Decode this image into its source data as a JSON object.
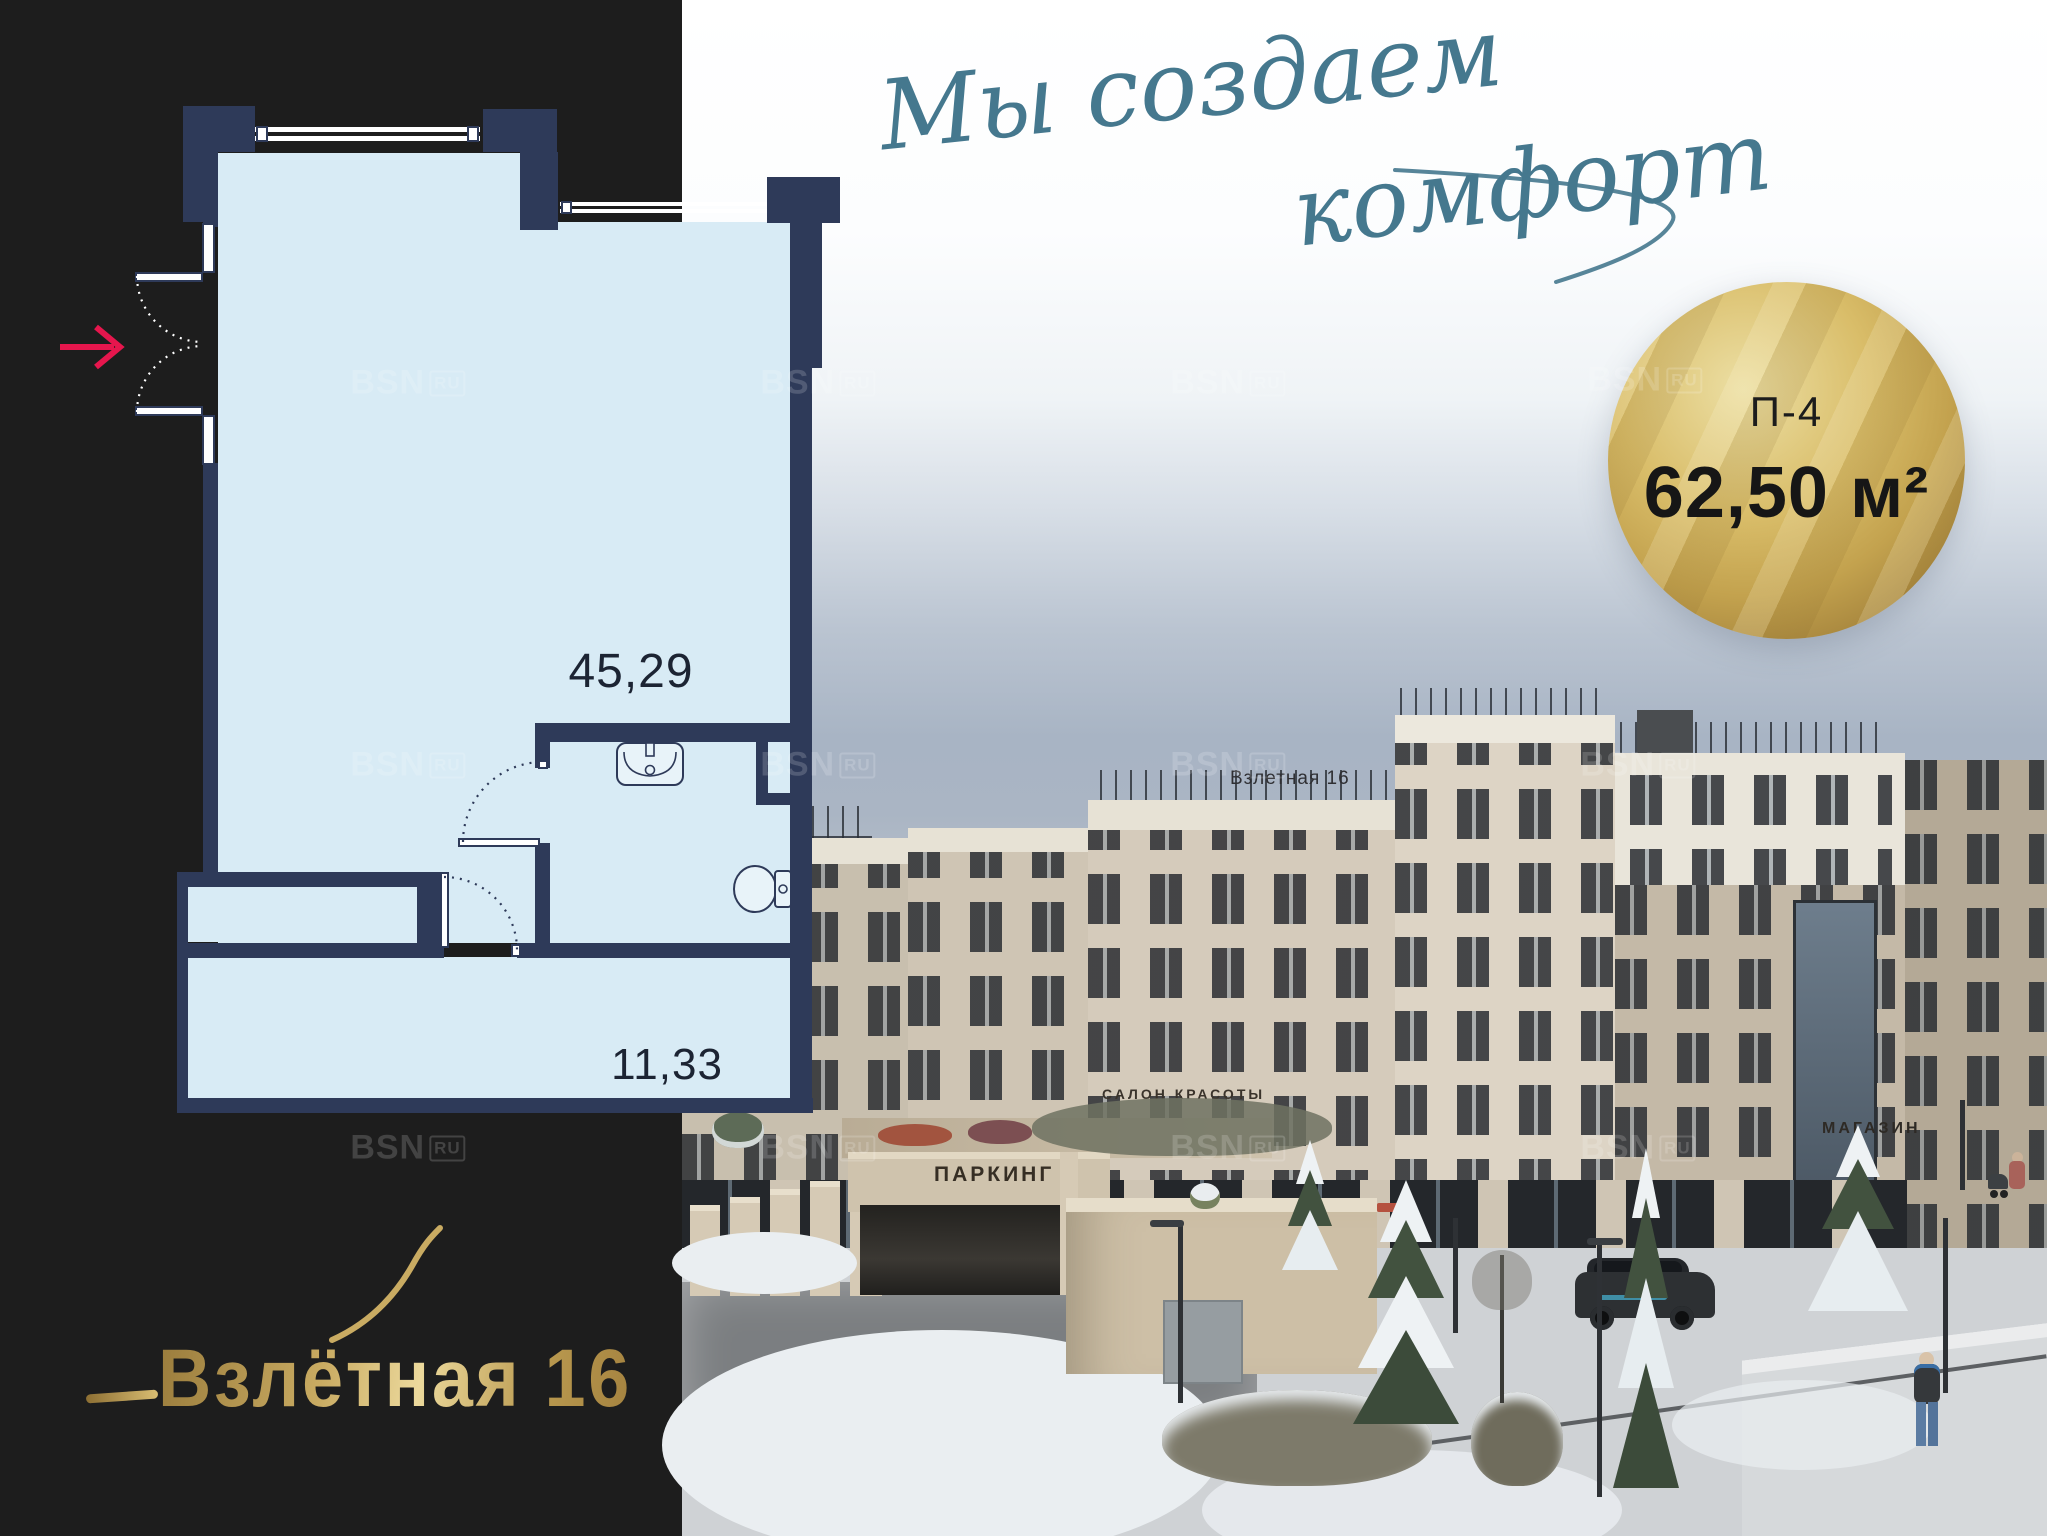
{
  "plan": {
    "area_main": "45,29",
    "area_secondary": "11,33",
    "wall_color": "#2e3a59",
    "room_fill_color": "#d8ebf5",
    "entry_arrow_color": "#e6164d"
  },
  "badge": {
    "line1": "П-4",
    "line2": "62,50 м²",
    "gold_color": "#c3a24e",
    "text_color": "#1c1c1c"
  },
  "tagline": {
    "line1": "Мы создаем",
    "line2": "комфорт",
    "color": "#45788e"
  },
  "logo": {
    "name": "Взлётная 16",
    "gold_color": "#c9ab62"
  },
  "photo": {
    "building_roof_sign": "Взлетная 16",
    "parking_sign": "ПАРКИНГ",
    "salon_sign": "САЛОН КРАСОТЫ",
    "shop_sign": "МАГАЗИН"
  },
  "watermark": {
    "brand": "BSN",
    "suffix": "RU",
    "positions": [
      {
        "x": 408,
        "y": 383
      },
      {
        "x": 818,
        "y": 383
      },
      {
        "x": 1228,
        "y": 383
      },
      {
        "x": 1645,
        "y": 380
      },
      {
        "x": 408,
        "y": 765
      },
      {
        "x": 818,
        "y": 765
      },
      {
        "x": 1228,
        "y": 765
      },
      {
        "x": 1638,
        "y": 765
      },
      {
        "x": 408,
        "y": 1148
      },
      {
        "x": 818,
        "y": 1148
      },
      {
        "x": 1228,
        "y": 1148
      },
      {
        "x": 1638,
        "y": 1148
      }
    ]
  }
}
